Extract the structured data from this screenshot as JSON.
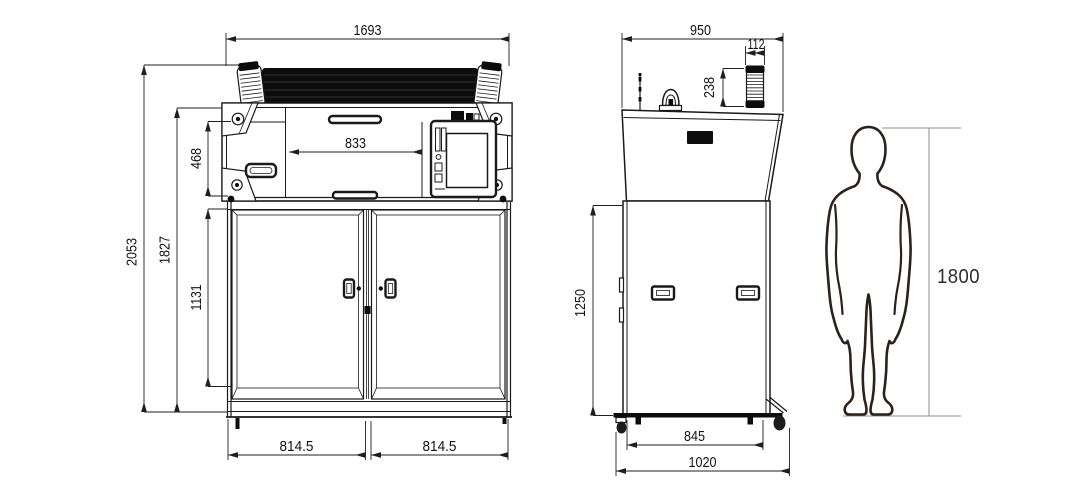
{
  "page": {
    "title": "Equipment outline dimension drawing",
    "background": "#ffffff"
  },
  "drawing": {
    "line_color": "#1a1a1a",
    "dark_fill": "#0c0c0c",
    "human_line_color": "#2d2119",
    "front_view": {
      "dimensions": {
        "overall_width": "1693",
        "opening_width": "833",
        "console_height": "468",
        "overall_height": "2053",
        "body_height": "1827",
        "door_height": "1131",
        "left_door_width": "814.5",
        "right_door_width": "814.5"
      }
    },
    "side_view": {
      "dimensions": {
        "top_depth": "950",
        "roller_diameter": "112",
        "roller_length": "238",
        "cabinet_height": "1250",
        "base_depth": "845",
        "overall_depth": "1020"
      }
    },
    "human_figure": {
      "height": "1800"
    }
  }
}
